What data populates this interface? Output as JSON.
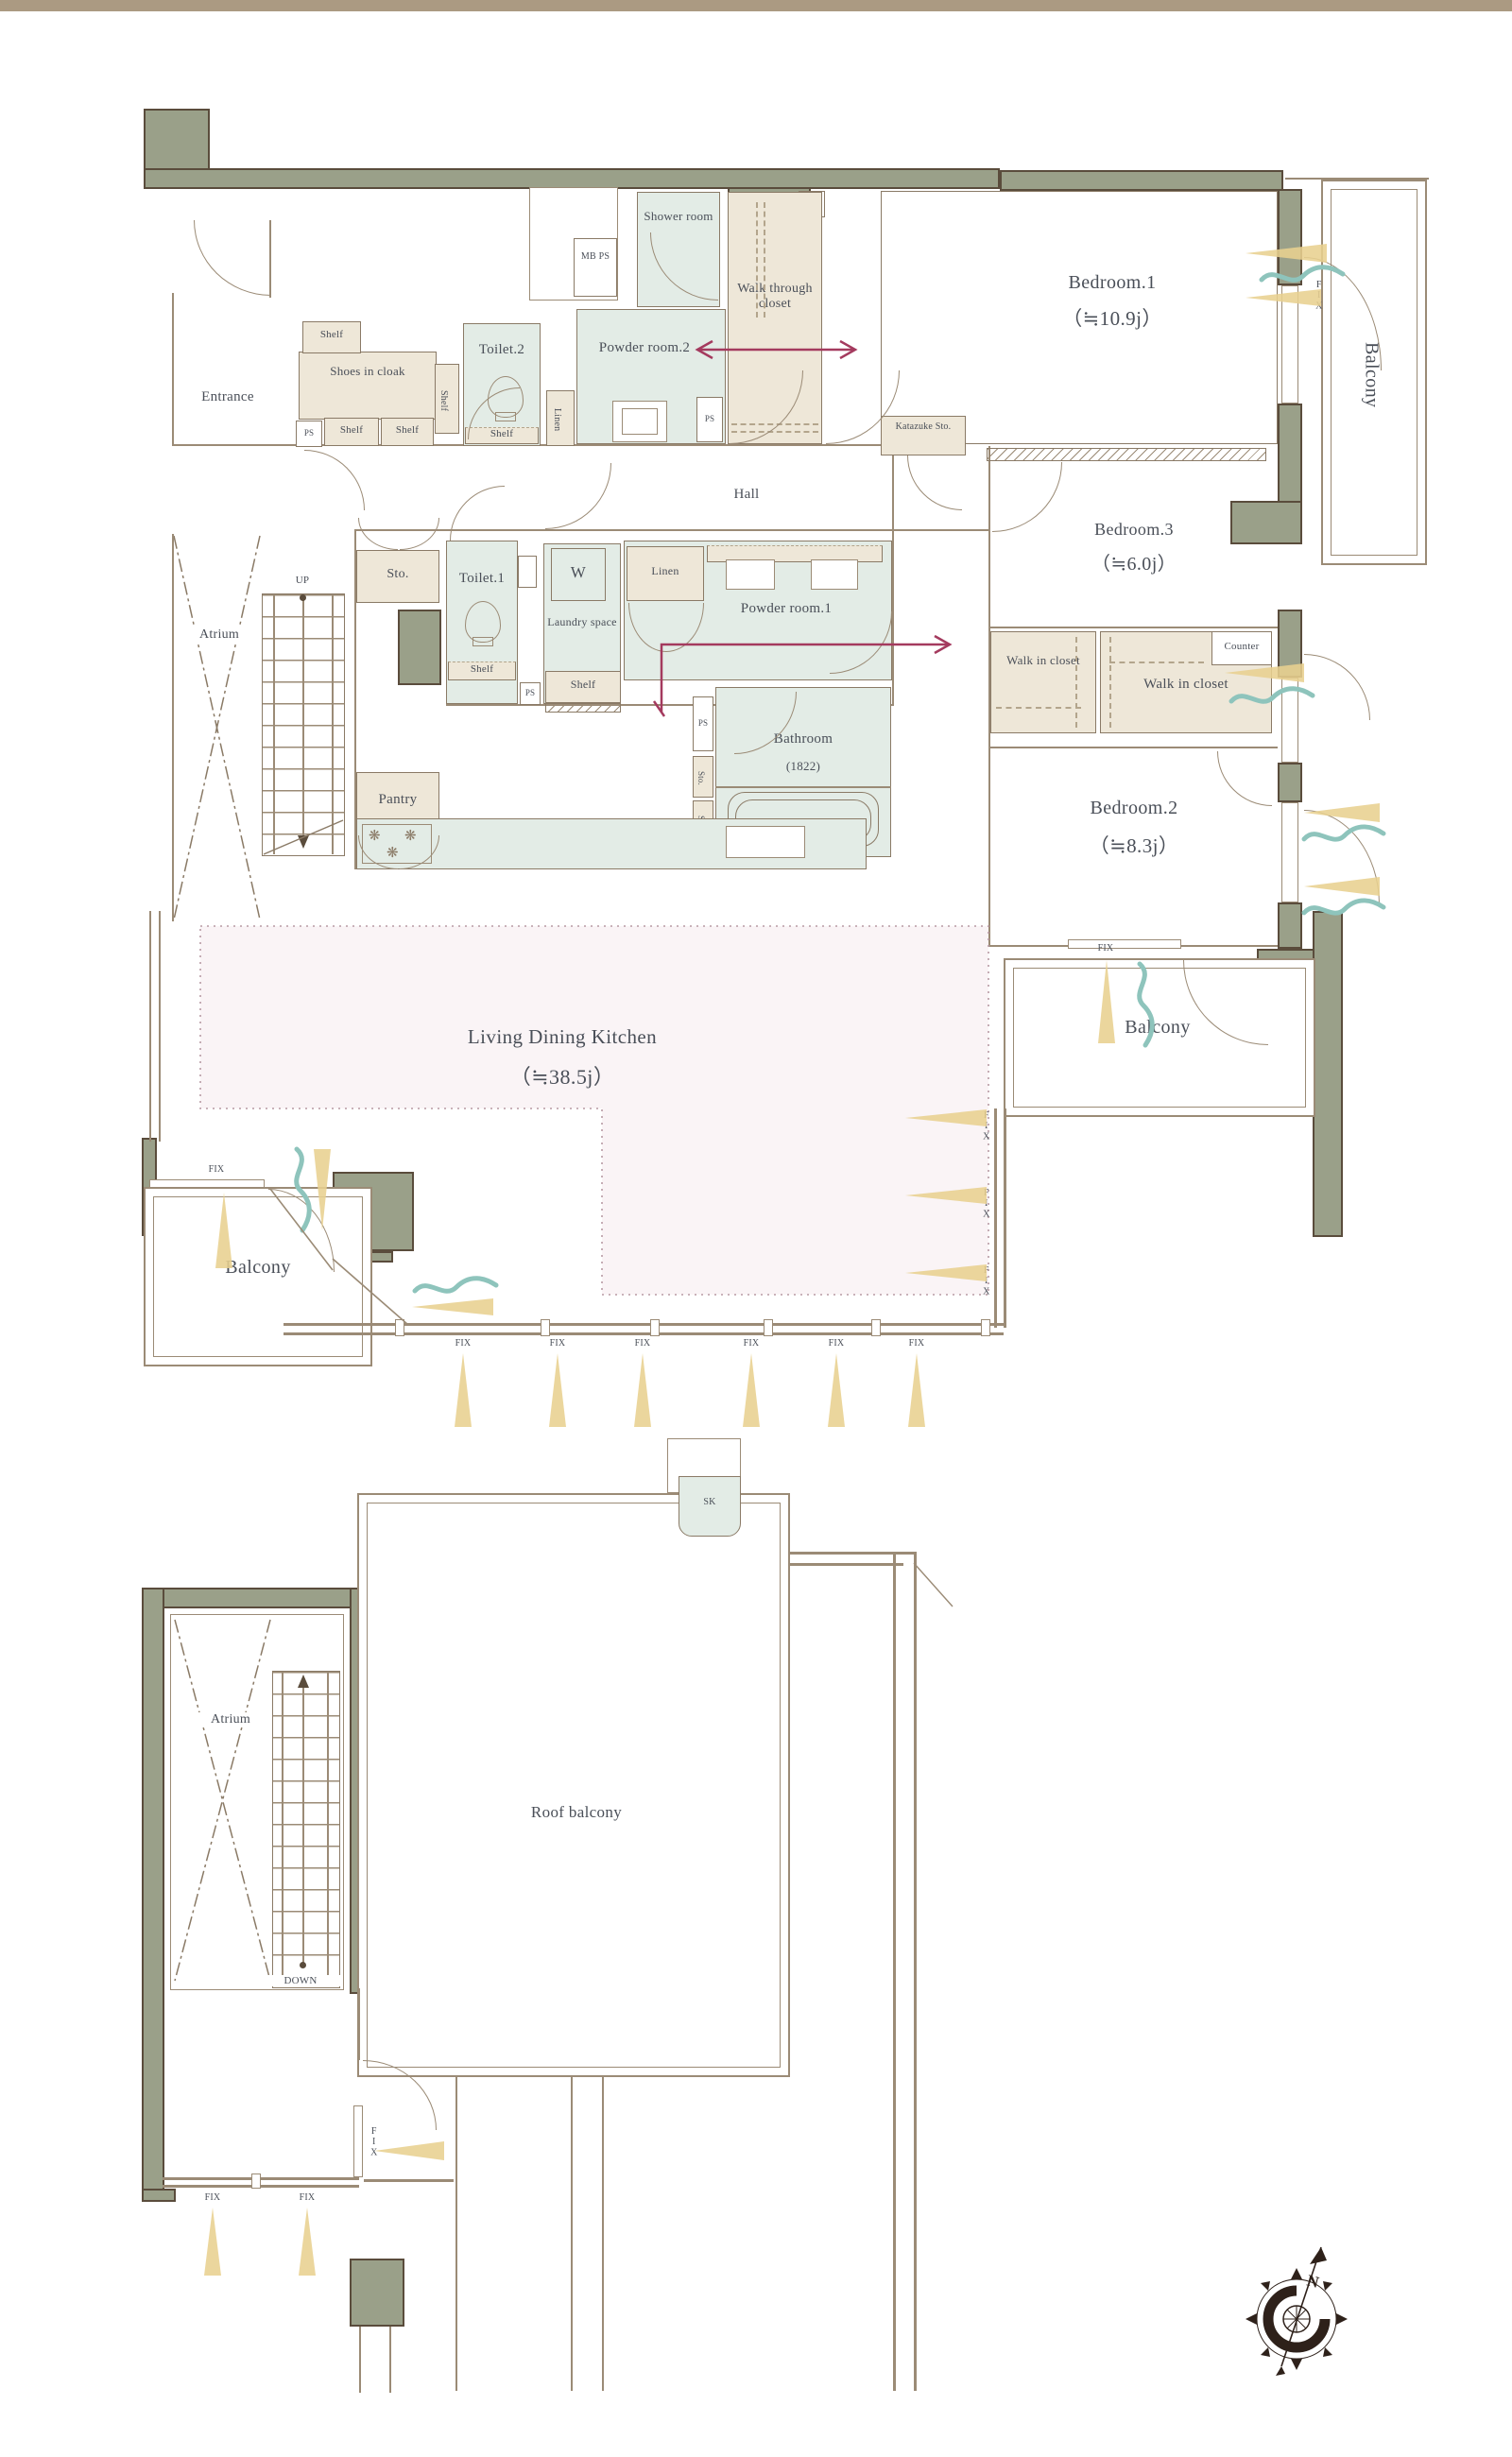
{
  "palette": {
    "top_bar": "#ab9a82",
    "wall_fill": "#9aa089",
    "wall_outline": "#5a4c3c",
    "line": "#9b8b76",
    "wet_room_fill": "#e3ece6",
    "closet_fill": "#eee7d8",
    "ldk_fill": "#faf4f6",
    "accent_arrow": "#a43a5e",
    "light_cone": "#e8d08f",
    "airflow_wave": "#8ec4bc",
    "text": "#4a4f58"
  },
  "shared": {
    "fix": "FIX",
    "ps": "PS",
    "shelf": "Shelf",
    "sto": "Sto.",
    "linen": "Linen",
    "balcony": "Balcony",
    "atrium": "Atrium",
    "walk_in_closet": "Walk in closet",
    "burner_icon": "❋",
    "north": "N"
  },
  "upper_floor": {
    "entrance": "Entrance",
    "shoes_in_cloak": "Shoes in cloak",
    "toilet2": "Toilet.2",
    "mb_ps": "MB PS",
    "shower_room": "Shower room",
    "powder_room2": "Powder room.2",
    "walk_through_closet": "Walk through closet",
    "bedroom1": "Bedroom.1",
    "bedroom1_size": "（≒10.9j）",
    "katazuke_sto": "Katazuke Sto.",
    "hall": "Hall",
    "toilet1": "Toilet.1",
    "washer": "W",
    "laundry_space": "Laundry space",
    "powder_room1": "Powder room.1",
    "bedroom3": "Bedroom.3",
    "bedroom3_size": "（≒6.0j）",
    "counter": "Counter",
    "bathroom": "Bathroom",
    "bathroom_size": "(1822)",
    "bedroom2": "Bedroom.2",
    "bedroom2_size": "（≒8.3j）",
    "pantry": "Pantry",
    "ldk": "Living Dining Kitchen",
    "ldk_size": "（≒38.5j）",
    "up": "UP"
  },
  "lower_floor": {
    "sk": "SK",
    "roof_balcony": "Roof balcony",
    "down": "DOWN"
  }
}
